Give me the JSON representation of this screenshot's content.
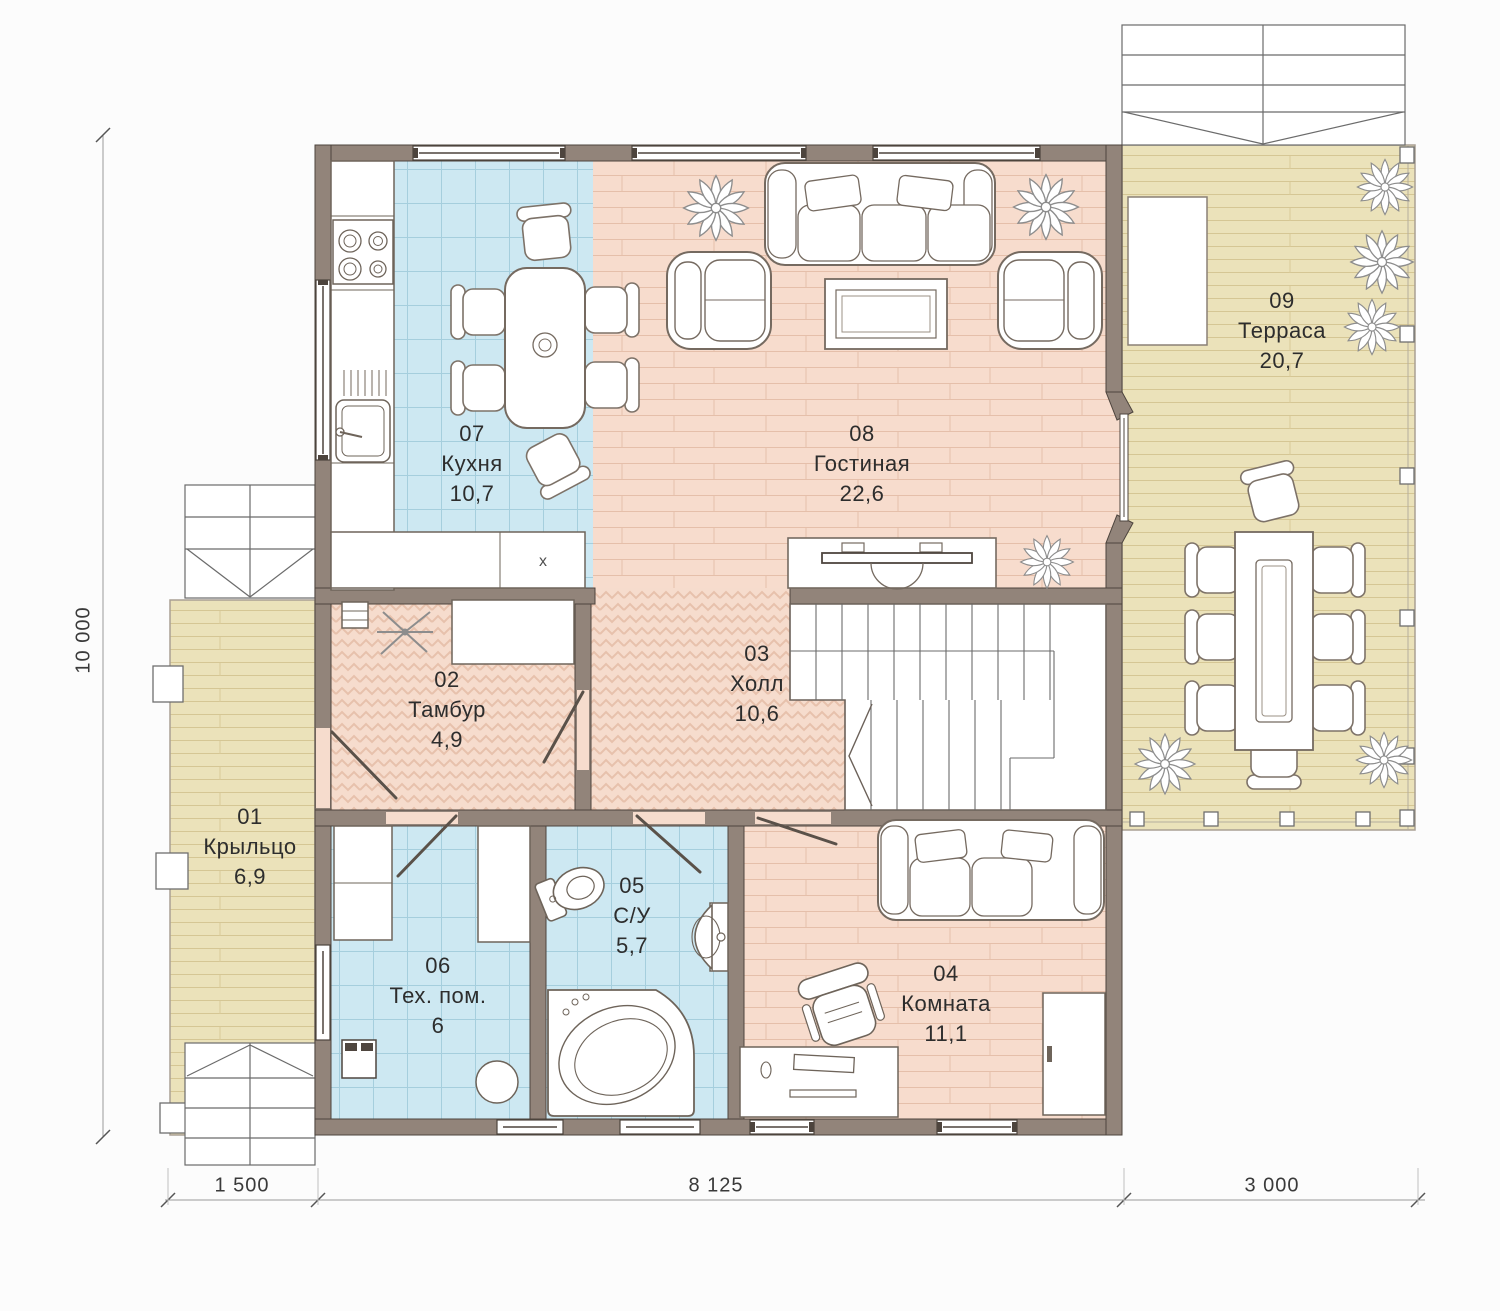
{
  "plan_title": "Floor plan, first floor",
  "rooms": {
    "porch": {
      "number": "01",
      "name": "Крыльцо",
      "area": "6,9"
    },
    "tambur": {
      "number": "02",
      "name": "Тамбур",
      "area": "4,9"
    },
    "hall": {
      "number": "03",
      "name": "Холл",
      "area": "10,6"
    },
    "room": {
      "number": "04",
      "name": "Комната",
      "area": "11,1"
    },
    "wc": {
      "number": "05",
      "name": "С/У",
      "area": "5,7"
    },
    "tech": {
      "number": "06",
      "name": "Тех. пом.",
      "area": "6"
    },
    "kitchen": {
      "number": "07",
      "name": "Кухня",
      "area": "10,7"
    },
    "living": {
      "number": "08",
      "name": "Гостиная",
      "area": "22,6"
    },
    "terrace": {
      "number": "09",
      "name": "Терраса",
      "area": "20,7"
    }
  },
  "dimensions": {
    "height_total": "10 000",
    "width_porch": "1 500",
    "width_house": "8 125",
    "width_terrace": "3 000"
  },
  "markers": {
    "kitchen_unit": "x"
  },
  "palette": {
    "wall": "#92847a",
    "wall_outline": "#4d443d",
    "tile_blue": "#cde8f2",
    "plank_pink": "#f7dccd",
    "deck_beige": "#ebe2ba",
    "furniture_outline": "#756a60",
    "text": "#2d2d2d"
  }
}
